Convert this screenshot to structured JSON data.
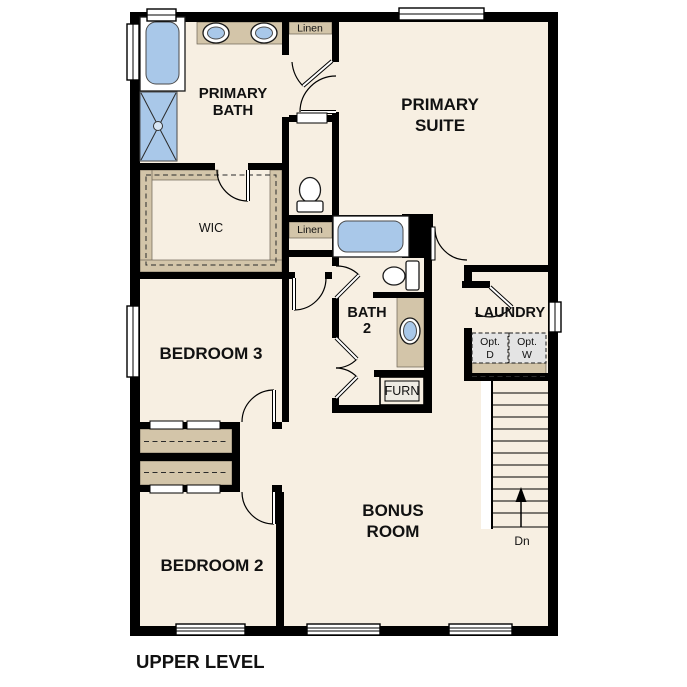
{
  "plan_title": "UPPER LEVEL",
  "colors": {
    "floor": "#f7efe2",
    "wall": "#000000",
    "shelf_tan": "#d3c5a9",
    "fixture_blue": "#a9c8e9",
    "appliance_gray": "#e4e4e4"
  },
  "rooms": {
    "primary_bath": {
      "line1": "PRIMARY",
      "line2": "BATH"
    },
    "primary_suite": {
      "line1": "PRIMARY",
      "line2": "SUITE"
    },
    "wic": {
      "label": "WIC"
    },
    "bedroom_3": {
      "label": "BEDROOM 3"
    },
    "bath_2": {
      "line1": "BATH",
      "line2": "2"
    },
    "laundry": {
      "label": "LAUNDRY"
    },
    "bonus_room": {
      "line1": "BONUS",
      "line2": "ROOM"
    },
    "bedroom_2": {
      "label": "BEDROOM 2"
    }
  },
  "closets": {
    "linen_upper": "Linen",
    "linen_lower": "Linen"
  },
  "fixtures": {
    "furnace": "FURN"
  },
  "laundry_options": {
    "dryer_line1": "Opt.",
    "dryer_line2": "D",
    "washer_line1": "Opt.",
    "washer_line2": "W"
  },
  "stairs": {
    "direction": "Dn"
  }
}
